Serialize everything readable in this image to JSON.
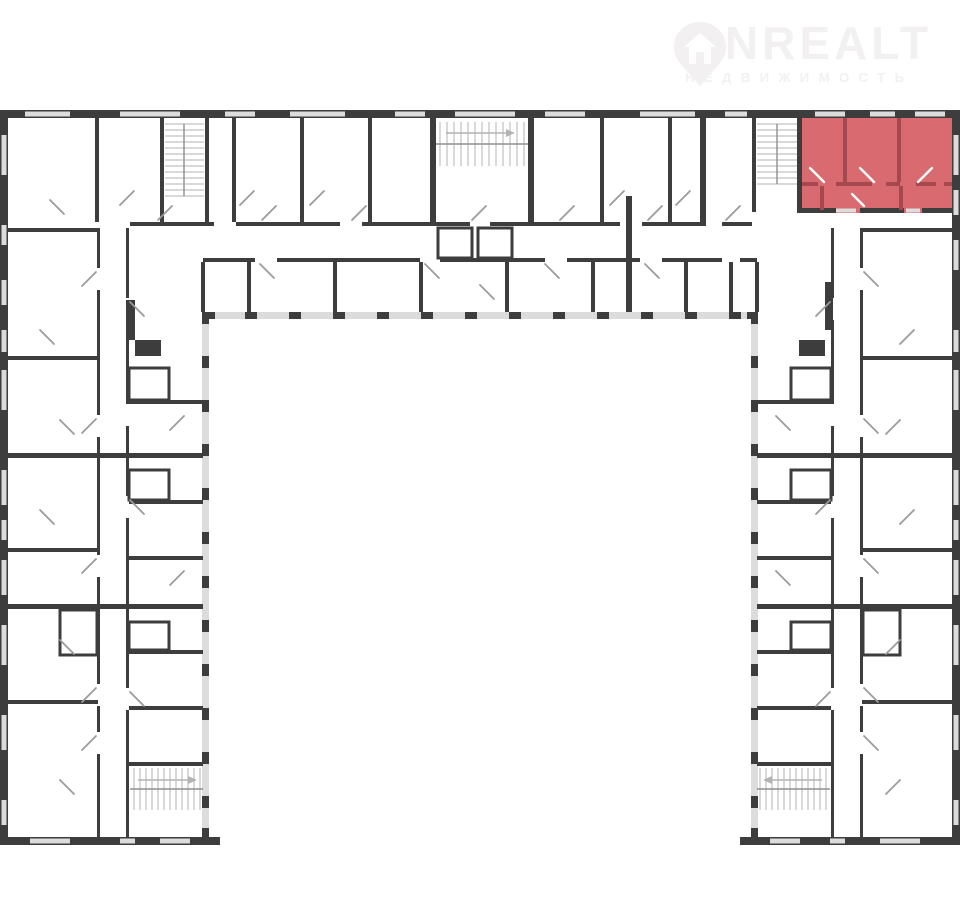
{
  "logo": {
    "brand": "ONREALT",
    "subtitle": "НЕДВИЖИМОСТЬ"
  },
  "colors": {
    "background": "#ffffff",
    "wall": "#3d3d3d",
    "window": "#dcdcdc",
    "door": "#9b9b9b",
    "stair": "#b3b3b3",
    "highlight_fill": "#d96b70",
    "highlight_wall": "#a3494f",
    "logo": "#f2f0f1"
  },
  "floor_plan": {
    "kind": "apartment-building-floor-plan",
    "shape": "U-shaped",
    "highlighted_apartment": {
      "position": "top-right",
      "fill": "#d96b70"
    },
    "stairwells": [
      "top-left",
      "top-center",
      "top-right",
      "left-wing-bottom",
      "right-wing-bottom"
    ]
  }
}
